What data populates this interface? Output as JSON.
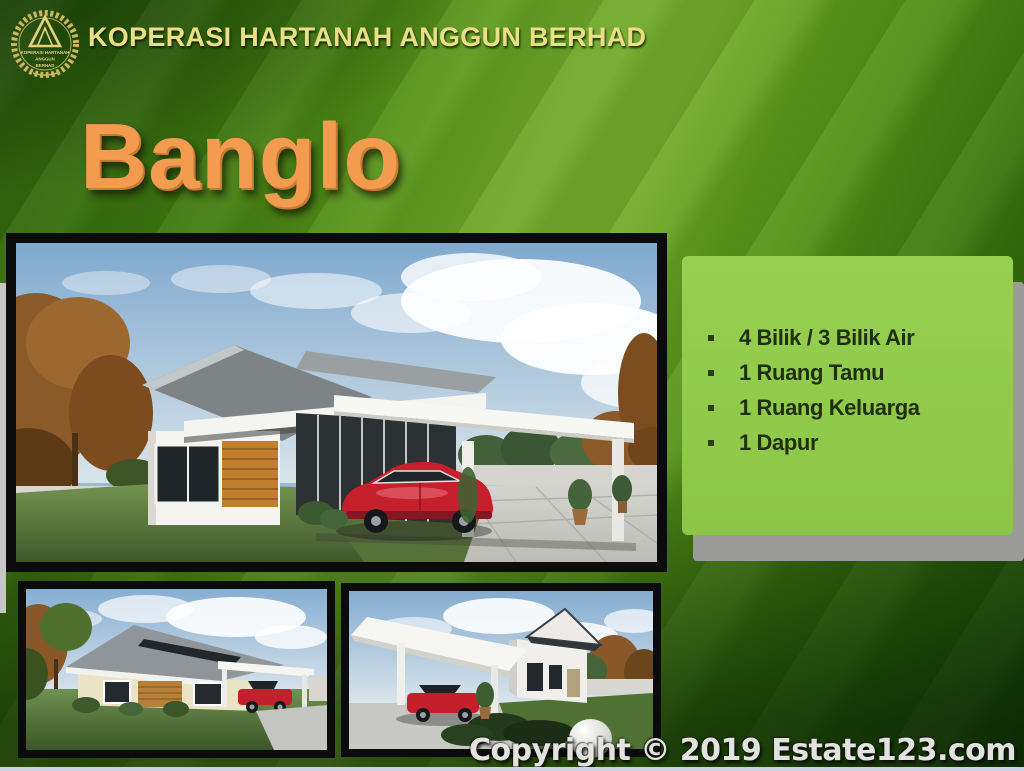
{
  "header": {
    "company_name": "KOPERASI HARTANAH ANGGUN BERHAD",
    "logo": {
      "line1": "KOPERASI HARTANAH",
      "line2": "ANGGUN",
      "line3": "BERHAD"
    }
  },
  "title": {
    "text": "Banglo"
  },
  "features": {
    "items": [
      "4 Bilik / 3 Bilik Air",
      "1 Ruang Tamu",
      "1 Ruang Keluarga",
      "1 Dapur"
    ]
  },
  "footer": {
    "copyright": "Copyright © 2019 Estate123.com"
  },
  "images": {
    "main": "bungalow-front-render",
    "small_left": "bungalow-side-render",
    "small_middle": "bungalow-carport-render"
  },
  "colors": {
    "background_dark_green": "#1d4a08",
    "background_light_green": "#6ea827",
    "panel_green": "#90c94b",
    "panel_shadow_gray": "#9b9b99",
    "title_orange": "#f39c50",
    "header_gold": "#ebdf86",
    "feature_text_dark": "#20300e",
    "frame_black": "#0b0b0b",
    "copyright_gray": "#e2e2e0",
    "bottom_strip_lavender": "#ccd2e2"
  }
}
